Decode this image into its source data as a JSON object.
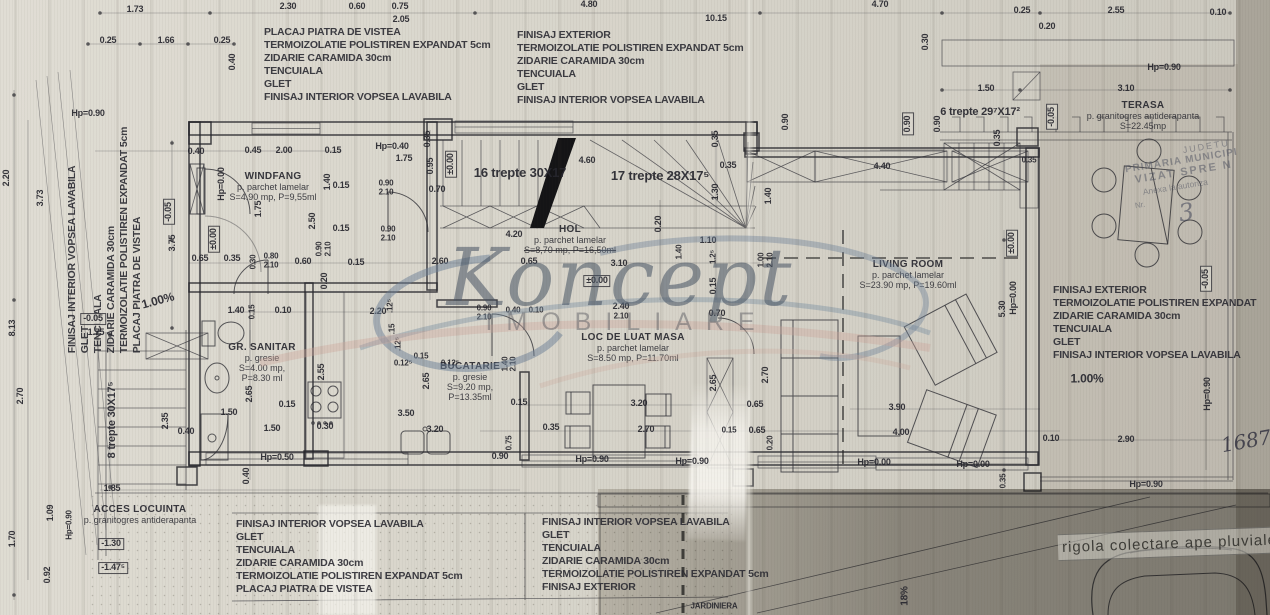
{
  "watermark": {
    "script": "Koncept",
    "sub": "IMOBILIARE"
  },
  "footer": {
    "rigola": "rigola colectare ape pluviale"
  },
  "stamp": {
    "lines": [
      "JUDETU",
      "PRIMARIA MUNICIPI",
      "VIZAT SPRE N",
      "Anexa la autoriza",
      "Nr.",
      "3"
    ]
  },
  "spec_blocks": [
    {
      "id": "top-left",
      "x": 264,
      "y": 26,
      "lines": [
        "PLACAJ PIATRA DE VISTEA",
        "TERMOIZOLATIE POLISTIREN EXPANDAT 5cm",
        "ZIDARIE CARAMIDA 30cm",
        "TENCUIALA",
        "GLET",
        "FINISAJ INTERIOR VOPSEA LAVABILA"
      ]
    },
    {
      "id": "top-center",
      "x": 517,
      "y": 29,
      "lines": [
        "FINISAJ EXTERIOR",
        "TERMOIZOLATIE POLISTIREN EXPANDAT 5cm",
        "ZIDARIE CARAMIDA 30cm",
        "TENCUIALA",
        "GLET",
        "FINISAJ INTERIOR VOPSEA LAVABILA"
      ]
    },
    {
      "id": "left-vertical",
      "x": 105,
      "y": 240,
      "rot": -90,
      "lines": [
        "FINISAJ INTERIOR VOPSEA LAVABILA",
        "GLET",
        "TENCUIALA",
        "ZIDARIE CARAMIDA 30cm",
        "TERMOIZOLATIE POLISTIREN EXPANDAT 5cm",
        "PLACAJ PIATRA DE VISTEA"
      ]
    },
    {
      "id": "right",
      "x": 1053,
      "y": 284,
      "lines": [
        "FINISAJ EXTERIOR",
        "TERMOIZOLATIE POLISTIREN EXPANDAT",
        "ZIDARIE CARAMIDA 30cm",
        "TENCUIALA",
        "GLET",
        "FINISAJ INTERIOR VOPSEA LAVABILA"
      ]
    },
    {
      "id": "bottom-left",
      "x": 236,
      "y": 518,
      "lines": [
        "FINISAJ INTERIOR VOPSEA LAVABILA",
        "GLET",
        "TENCUIALA",
        "ZIDARIE CARAMIDA 30cm",
        "TERMOIZOLATIE POLISTIREN EXPANDAT 5cm",
        "PLACAJ PIATRA DE VISTEA"
      ]
    },
    {
      "id": "bottom-center",
      "x": 542,
      "y": 516,
      "lines": [
        "FINISAJ INTERIOR VOPSEA LAVABILA",
        "GLET",
        "TENCUIALA",
        "ZIDARIE CARAMIDA 30cm",
        "TERMOIZOLATIE POLISTIREN EXPANDAT 5cm",
        "FINISAJ EXTERIOR"
      ]
    }
  ],
  "rooms": [
    {
      "id": "windfang",
      "x": 273,
      "y": 171,
      "lines": [
        "WINDFANG",
        "p. parchet lamelar",
        "S=4.90 mp, P=9,55ml"
      ]
    },
    {
      "id": "hol",
      "x": 570,
      "y": 224,
      "lines": [
        "HOL",
        "p. parchet lamelar",
        "S=8,70 mp, P=16,50ml"
      ],
      "strike": [
        2
      ]
    },
    {
      "id": "gr-sanitar",
      "x": 262,
      "y": 342,
      "lines": [
        "GR. SANITAR",
        "p. gresie",
        "S=4.00 mp,",
        "P=8.30 ml"
      ]
    },
    {
      "id": "bucatarie",
      "x": 470,
      "y": 361,
      "lines": [
        "BUCATARIE",
        "p. gresie",
        "S=9.20 mp,",
        "P=13.35ml"
      ]
    },
    {
      "id": "loc-de-luat-masa",
      "x": 633,
      "y": 332,
      "lines": [
        "LOC DE LUAT MASA",
        "p. parchet lamelar",
        "S=8.50 mp, P=11.70ml"
      ]
    },
    {
      "id": "living-room",
      "x": 908,
      "y": 259,
      "lines": [
        "LIVING ROOM",
        "p. parchet lamelar",
        "S=23.90 mp, P=19.60ml"
      ]
    },
    {
      "id": "terasa",
      "x": 1143,
      "y": 100,
      "lines": [
        "TERASA",
        "p. granitogres antiderapanta",
        "S=22.45mp"
      ]
    },
    {
      "id": "acces-locuinta",
      "x": 140,
      "y": 504,
      "lines": [
        "ACCES LOCUINTA",
        "p. granitogres antiderapanta"
      ]
    }
  ],
  "labels": [
    {
      "t": "1.73",
      "x": 135,
      "y": 10
    },
    {
      "t": "2.30",
      "x": 288,
      "y": 7
    },
    {
      "t": "0.60",
      "x": 357,
      "y": 7
    },
    {
      "t": "0.75",
      "x": 400,
      "y": 7
    },
    {
      "t": "2.05",
      "x": 401,
      "y": 20
    },
    {
      "t": "4.80",
      "x": 589,
      "y": 5
    },
    {
      "t": "10.15",
      "x": 716,
      "y": 19
    },
    {
      "t": "4.70",
      "x": 880,
      "y": 5
    },
    {
      "t": "0.25",
      "x": 1022,
      "y": 11
    },
    {
      "t": "0.20",
      "x": 1047,
      "y": 27
    },
    {
      "t": "2.55",
      "x": 1116,
      "y": 11
    },
    {
      "t": "0.10",
      "x": 1218,
      "y": 13
    },
    {
      "t": "0.25",
      "x": 108,
      "y": 41
    },
    {
      "t": "1.66",
      "x": 166,
      "y": 41
    },
    {
      "t": "0.25",
      "x": 222,
      "y": 41
    },
    {
      "t": "0.40",
      "x": 233,
      "y": 62,
      "r": -90
    },
    {
      "t": "Hp=0.90",
      "x": 88,
      "y": 114
    },
    {
      "t": "Hp=0.90",
      "x": 1164,
      "y": 68
    },
    {
      "t": "0.30",
      "x": 926,
      "y": 42,
      "r": -90
    },
    {
      "t": "0.90",
      "x": 786,
      "y": 122,
      "r": -90
    },
    {
      "t": "0.90",
      "x": 908,
      "y": 124,
      "r": -90,
      "b": 1
    },
    {
      "t": "0.90",
      "x": 938,
      "y": 124,
      "r": -90
    },
    {
      "t": "1.50",
      "x": 986,
      "y": 89
    },
    {
      "t": "3.10",
      "x": 1126,
      "y": 89
    },
    {
      "t": "6 trepte 29⁷X17²",
      "x": 980,
      "y": 112,
      "f": 11
    },
    {
      "t": "-0.05",
      "x": 1052,
      "y": 117,
      "r": -90,
      "b": 1
    },
    {
      "t": "0.35",
      "x": 998,
      "y": 138,
      "r": -90
    },
    {
      "t": "0.35",
      "x": 1029,
      "y": 161,
      "f": 8
    },
    {
      "t": "0.40",
      "x": 196,
      "y": 152
    },
    {
      "t": "0.45",
      "x": 253,
      "y": 151
    },
    {
      "t": "2.00",
      "x": 284,
      "y": 151
    },
    {
      "t": "0.15",
      "x": 333,
      "y": 151
    },
    {
      "t": "Hp=0.40",
      "x": 392,
      "y": 147
    },
    {
      "t": "1.75",
      "x": 404,
      "y": 159
    },
    {
      "t": "0.35",
      "x": 428,
      "y": 139,
      "r": -90
    },
    {
      "t": "0.95",
      "x": 431,
      "y": 166,
      "r": -90
    },
    {
      "t": "Hp=0.00",
      "x": 222,
      "y": 184,
      "r": -90
    },
    {
      "t": "1.40",
      "x": 328,
      "y": 182,
      "r": -90
    },
    {
      "t": "0.15",
      "x": 341,
      "y": 186
    },
    {
      "t": "0.90",
      "x": 386,
      "y": 184,
      "f": 8
    },
    {
      "t": "2.10",
      "x": 386,
      "y": 193,
      "f": 8
    },
    {
      "t": "0.70",
      "x": 437,
      "y": 190
    },
    {
      "t": "±0.00",
      "x": 451,
      "y": 164,
      "r": -90,
      "b": 1
    },
    {
      "t": "1.75",
      "x": 259,
      "y": 209,
      "r": -90
    },
    {
      "t": "2.50",
      "x": 313,
      "y": 221,
      "r": -90
    },
    {
      "t": "0.15",
      "x": 341,
      "y": 229
    },
    {
      "t": "0.90",
      "x": 388,
      "y": 230,
      "f": 8
    },
    {
      "t": "2.10",
      "x": 388,
      "y": 239,
      "f": 8
    },
    {
      "t": "±0.00",
      "x": 214,
      "y": 239,
      "r": -90,
      "b": 1
    },
    {
      "t": "0.65",
      "x": 200,
      "y": 259
    },
    {
      "t": "0.35",
      "x": 232,
      "y": 259
    },
    {
      "t": "0.30",
      "x": 254,
      "y": 262,
      "r": -90,
      "f": 8
    },
    {
      "t": "0.80",
      "x": 271,
      "y": 257,
      "f": 8
    },
    {
      "t": "2.10",
      "x": 271,
      "y": 266,
      "f": 8
    },
    {
      "t": "0.60",
      "x": 303,
      "y": 262
    },
    {
      "t": "0.90",
      "x": 320,
      "y": 249,
      "r": -90,
      "f": 8
    },
    {
      "t": "2.10",
      "x": 329,
      "y": 249,
      "r": -90,
      "f": 8
    },
    {
      "t": "0.15",
      "x": 356,
      "y": 263
    },
    {
      "t": "0.20",
      "x": 325,
      "y": 281,
      "r": -90
    },
    {
      "t": "2.60",
      "x": 440,
      "y": 262
    },
    {
      "t": "16 trepte 30X17",
      "x": 520,
      "y": 173,
      "f": 13
    },
    {
      "t": "4.60",
      "x": 587,
      "y": 161
    },
    {
      "t": "17 trepte 28X17⁵",
      "x": 660,
      "y": 176,
      "f": 13
    },
    {
      "t": "0.35",
      "x": 716,
      "y": 139,
      "r": -90
    },
    {
      "t": "0.35",
      "x": 728,
      "y": 166
    },
    {
      "t": "1.30",
      "x": 716,
      "y": 192,
      "r": -90
    },
    {
      "t": "1.40",
      "x": 769,
      "y": 196,
      "r": -90
    },
    {
      "t": "4.40",
      "x": 882,
      "y": 167
    },
    {
      "t": "0.20",
      "x": 659,
      "y": 224,
      "r": -90
    },
    {
      "t": "4.20",
      "x": 514,
      "y": 235
    },
    {
      "t": "1.10",
      "x": 708,
      "y": 241
    },
    {
      "t": "1.2⁵",
      "x": 714,
      "y": 257,
      "r": -90,
      "f": 8
    },
    {
      "t": "1.00",
      "x": 762,
      "y": 260,
      "r": -90,
      "f": 8
    },
    {
      "t": "2.10",
      "x": 771,
      "y": 260,
      "r": -90,
      "f": 8
    },
    {
      "t": "0.15",
      "x": 714,
      "y": 286,
      "r": -90
    },
    {
      "t": "1.40",
      "x": 680,
      "y": 252,
      "r": -90,
      "f": 8
    },
    {
      "t": "0.65",
      "x": 529,
      "y": 262
    },
    {
      "t": "3.10",
      "x": 619,
      "y": 264
    },
    {
      "t": "±0.00",
      "x": 597,
      "y": 281,
      "b": 1
    },
    {
      "t": "0.90",
      "x": 484,
      "y": 309,
      "f": 8
    },
    {
      "t": "2.10",
      "x": 484,
      "y": 318,
      "f": 8
    },
    {
      "t": "0.40",
      "x": 513,
      "y": 311,
      "f": 8
    },
    {
      "t": "0.10",
      "x": 536,
      "y": 311,
      "f": 8
    },
    {
      "t": "2.40",
      "x": 621,
      "y": 307
    },
    {
      "t": "2.10",
      "x": 621,
      "y": 317,
      "f": 8
    },
    {
      "t": "0.70",
      "x": 717,
      "y": 314
    },
    {
      "t": "1.40",
      "x": 236,
      "y": 311
    },
    {
      "t": "0.15",
      "x": 253,
      "y": 312,
      "r": -90,
      "f": 8
    },
    {
      "t": "0.10",
      "x": 283,
      "y": 311
    },
    {
      "t": "2.20",
      "x": 378,
      "y": 312
    },
    {
      "t": ".12⁵",
      "x": 391,
      "y": 306,
      "r": -90,
      "f": 8
    },
    {
      "t": ".15",
      "x": 393,
      "y": 329,
      "r": -90,
      "f": 8
    },
    {
      "t": ".12⁵",
      "x": 399,
      "y": 344,
      "r": -90,
      "f": 8
    },
    {
      "t": "0.15",
      "x": 421,
      "y": 357,
      "f": 8
    },
    {
      "t": "0.12⁵",
      "x": 403,
      "y": 364,
      "f": 8
    },
    {
      "t": "0.12⁵",
      "x": 450,
      "y": 364,
      "f": 8
    },
    {
      "t": "2.65",
      "x": 250,
      "y": 394,
      "r": -90
    },
    {
      "t": "2.55",
      "x": 322,
      "y": 372,
      "r": -90
    },
    {
      "t": "2.65",
      "x": 427,
      "y": 381,
      "r": -90
    },
    {
      "t": "0.15",
      "x": 287,
      "y": 405
    },
    {
      "t": "3.50",
      "x": 406,
      "y": 414
    },
    {
      "t": "1.50",
      "x": 229,
      "y": 413
    },
    {
      "t": "1.50",
      "x": 272,
      "y": 429
    },
    {
      "t": "0.30",
      "x": 325,
      "y": 427
    },
    {
      "t": "3.20",
      "x": 435,
      "y": 430
    },
    {
      "t": "0.40",
      "x": 186,
      "y": 432
    },
    {
      "t": "Hp=0.50",
      "x": 277,
      "y": 458
    },
    {
      "t": "0.40",
      "x": 247,
      "y": 476,
      "r": -90
    },
    {
      "t": "1.40",
      "x": 506,
      "y": 364,
      "r": -90,
      "f": 8
    },
    {
      "t": "2.10",
      "x": 514,
      "y": 364,
      "r": -90,
      "f": 8
    },
    {
      "t": "0.15",
      "x": 519,
      "y": 403
    },
    {
      "t": "0.35",
      "x": 551,
      "y": 428
    },
    {
      "t": "0.75",
      "x": 510,
      "y": 443,
      "r": -90,
      "f": 8
    },
    {
      "t": "0.90",
      "x": 500,
      "y": 457
    },
    {
      "t": "Hp=0.90",
      "x": 592,
      "y": 460
    },
    {
      "t": "Hp=0.90",
      "x": 692,
      "y": 462
    },
    {
      "t": "3.20",
      "x": 639,
      "y": 404
    },
    {
      "t": "2.70",
      "x": 646,
      "y": 430
    },
    {
      "t": "2.65",
      "x": 714,
      "y": 383,
      "r": -90
    },
    {
      "t": "2.70",
      "x": 766,
      "y": 375,
      "r": -90
    },
    {
      "t": "0.65",
      "x": 755,
      "y": 405
    },
    {
      "t": "0.15",
      "x": 729,
      "y": 431,
      "f": 8
    },
    {
      "t": "0.65",
      "x": 757,
      "y": 431
    },
    {
      "t": "0.20",
      "x": 771,
      "y": 443,
      "r": -90,
      "f": 8
    },
    {
      "t": "5.30",
      "x": 1003,
      "y": 309,
      "r": -90
    },
    {
      "t": "±0.00",
      "x": 1012,
      "y": 243,
      "r": -90,
      "b": 1
    },
    {
      "t": "Hp=0.00",
      "x": 1014,
      "y": 298,
      "r": -90
    },
    {
      "t": "3.90",
      "x": 897,
      "y": 408
    },
    {
      "t": "4.00",
      "x": 901,
      "y": 433
    },
    {
      "t": "0.10",
      "x": 1051,
      "y": 439
    },
    {
      "t": "Hp=0.00",
      "x": 874,
      "y": 463
    },
    {
      "t": "Hp=0.00",
      "x": 973,
      "y": 465
    },
    {
      "t": "0.35",
      "x": 1004,
      "y": 481,
      "r": -90,
      "f": 8
    },
    {
      "t": "-0.05",
      "x": 1206,
      "y": 279,
      "r": -90,
      "b": 1
    },
    {
      "t": "1.00%",
      "x": 1087,
      "y": 379,
      "f": 12
    },
    {
      "t": "Hp=0.90",
      "x": 1208,
      "y": 394,
      "r": -90
    },
    {
      "t": "2.90",
      "x": 1126,
      "y": 440
    },
    {
      "t": "Hp=0.90",
      "x": 1146,
      "y": 485
    },
    {
      "t": "1687",
      "x": 1246,
      "y": 441,
      "w": "hw",
      "r": -10,
      "f": 20,
      "n": "handwritten-number"
    },
    {
      "t": "2.20",
      "x": 7,
      "y": 178,
      "r": -90
    },
    {
      "t": "3.73",
      "x": 41,
      "y": 198,
      "r": -90
    },
    {
      "t": "8.13",
      "x": 13,
      "y": 328,
      "r": -90
    },
    {
      "t": "2.70",
      "x": 21,
      "y": 396,
      "r": -90
    },
    {
      "t": "-0.05",
      "x": 169,
      "y": 212,
      "r": -90,
      "b": 1
    },
    {
      "t": "3.75",
      "x": 173,
      "y": 243,
      "r": -90
    },
    {
      "t": "1.00%",
      "x": 158,
      "y": 301,
      "r": -15,
      "f": 12
    },
    {
      "t": "-0.05",
      "x": 93,
      "y": 319,
      "b": 1
    },
    {
      "t": "1.75",
      "x": 96,
      "y": 333
    },
    {
      "t": "8 trepte 30X17⁵",
      "x": 112,
      "y": 420,
      "r": -90,
      "f": 11
    },
    {
      "t": "2.35",
      "x": 166,
      "y": 421,
      "r": -90
    },
    {
      "t": "1.85",
      "x": 112,
      "y": 489
    },
    {
      "t": "1.70",
      "x": 13,
      "y": 539,
      "r": -90
    },
    {
      "t": "1.09",
      "x": 51,
      "y": 513,
      "r": -90
    },
    {
      "t": "Hp=0.90",
      "x": 70,
      "y": 525,
      "r": -90,
      "f": 8
    },
    {
      "t": "0.92",
      "x": 48,
      "y": 575,
      "r": -90
    },
    {
      "t": "-1.30",
      "x": 111,
      "y": 544,
      "b": 1
    },
    {
      "t": "-1.47⁵",
      "x": 113,
      "y": 568,
      "b": 1
    },
    {
      "t": "18%",
      "x": 905,
      "y": 596,
      "r": -90,
      "f": 10,
      "n": "slope-label"
    },
    {
      "t": "JARDINIERA",
      "x": 714,
      "y": 607,
      "f": 8,
      "n": "jardiniera-label"
    }
  ]
}
